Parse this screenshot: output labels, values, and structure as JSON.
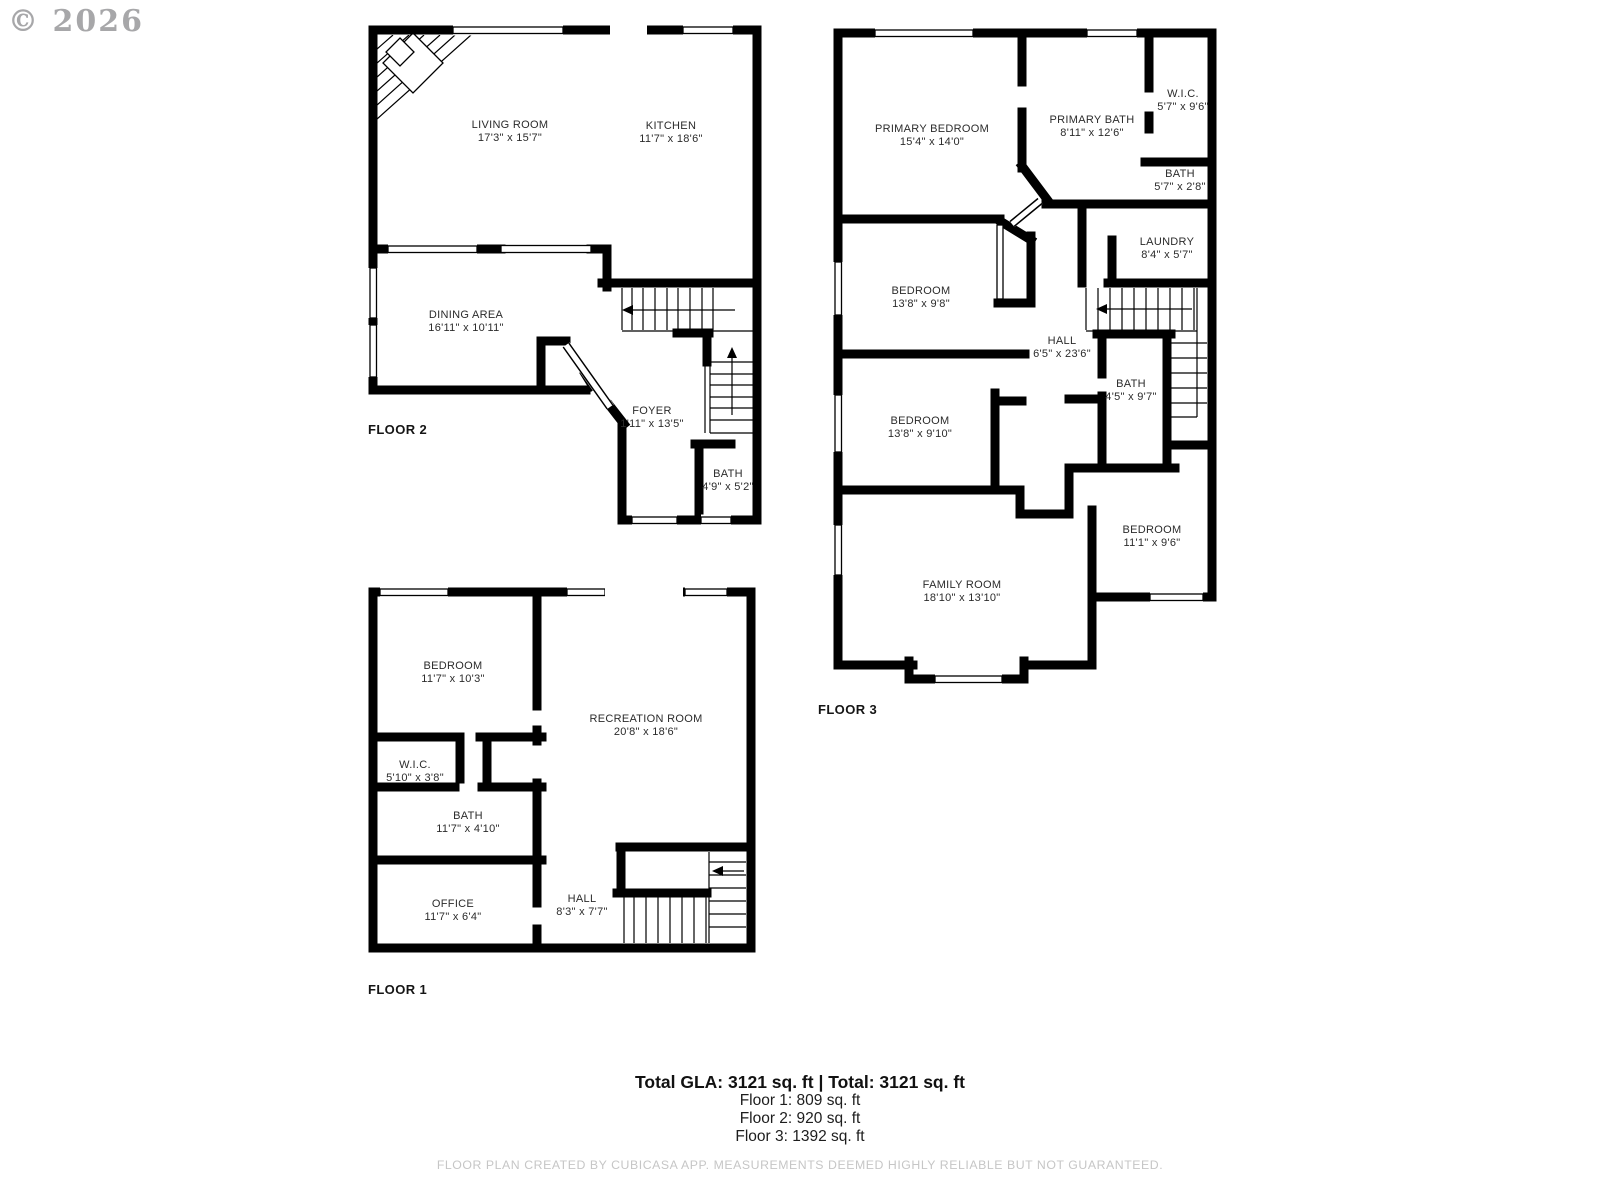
{
  "watermark": "© 2026",
  "colors": {
    "wall": "#000000",
    "text": "#2b2b2b",
    "footer_gray": "#c6c6c6"
  },
  "floors": [
    {
      "label": "FLOOR 2",
      "rooms": [
        {
          "name": "LIVING ROOM",
          "dims": "17'3\" x 15'7\""
        },
        {
          "name": "KITCHEN",
          "dims": "11'7\" x 18'6\""
        },
        {
          "name": "DINING AREA",
          "dims": "16'11\" x 10'11\""
        },
        {
          "name": "FOYER",
          "dims": "1'11\" x 13'5\""
        },
        {
          "name": "BATH",
          "dims": "4'9\" x 5'2\""
        }
      ]
    },
    {
      "label": "FLOOR 3",
      "rooms": [
        {
          "name": "PRIMARY BEDROOM",
          "dims": "15'4\" x 14'0\""
        },
        {
          "name": "PRIMARY BATH",
          "dims": "8'11\" x 12'6\""
        },
        {
          "name": "W.I.C.",
          "dims": "5'7\" x 9'6\""
        },
        {
          "name": "BATH",
          "dims": "5'7\" x 2'8\""
        },
        {
          "name": "LAUNDRY",
          "dims": "8'4\" x 5'7\""
        },
        {
          "name": "BEDROOM",
          "dims": "13'8\" x 9'8\""
        },
        {
          "name": "HALL",
          "dims": "6'5\" x 23'6\""
        },
        {
          "name": "BEDROOM",
          "dims": "13'8\" x 9'10\""
        },
        {
          "name": "BATH",
          "dims": "4'5\" x 9'7\""
        },
        {
          "name": "BEDROOM",
          "dims": "11'1\" x 9'6\""
        },
        {
          "name": "FAMILY ROOM",
          "dims": "18'10\" x 13'10\""
        }
      ]
    },
    {
      "label": "FLOOR 1",
      "rooms": [
        {
          "name": "BEDROOM",
          "dims": "11'7\" x 10'3\""
        },
        {
          "name": "RECREATION ROOM",
          "dims": "20'8\" x 18'6\""
        },
        {
          "name": "W.I.C.",
          "dims": "5'10\" x 3'8\""
        },
        {
          "name": "BATH",
          "dims": "11'7\" x 4'10\""
        },
        {
          "name": "OFFICE",
          "dims": "11'7\" x 6'4\""
        },
        {
          "name": "HALL",
          "dims": "8'3\" x 7'7\""
        }
      ]
    }
  ],
  "summary": {
    "total_line": "Total GLA: 3121 sq. ft | Total: 3121 sq. ft",
    "floor_lines": [
      "Floor 1: 809 sq. ft",
      "Floor 2: 920 sq. ft",
      "Floor 3: 1392 sq. ft"
    ]
  },
  "footer": "FLOOR PLAN CREATED BY CUBICASA APP. MEASUREMENTS DEEMED HIGHLY RELIABLE BUT NOT GUARANTEED."
}
